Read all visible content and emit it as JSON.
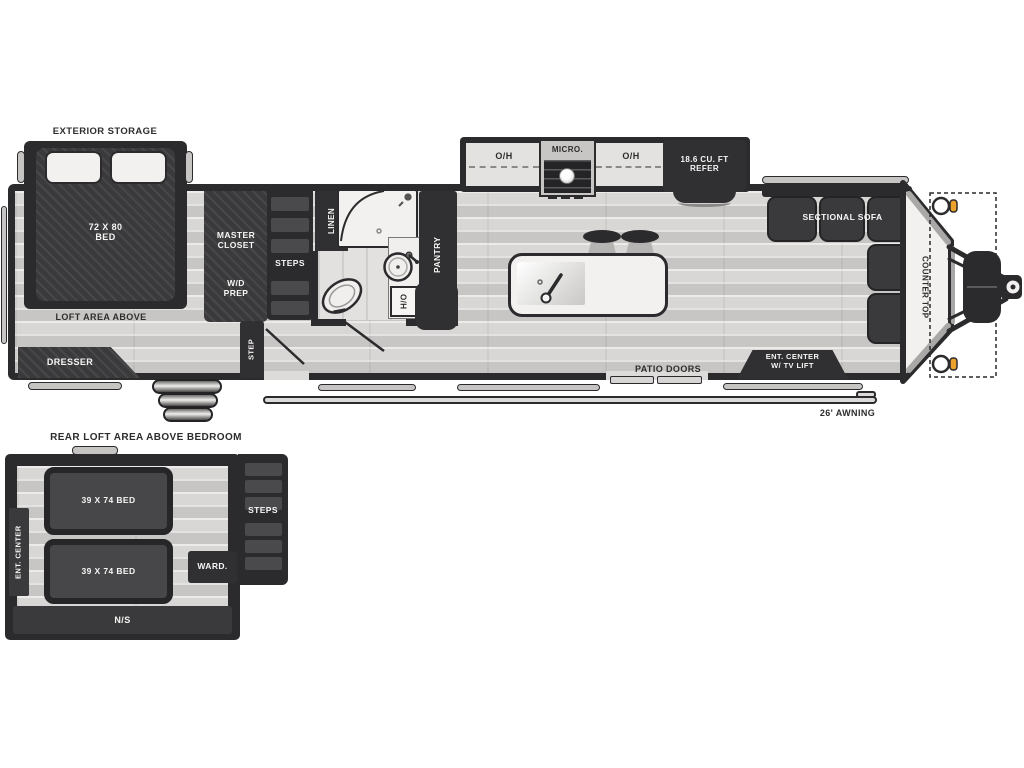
{
  "main_plan": {
    "exterior_storage_label": "EXTERIOR STORAGE",
    "bed": {
      "line1": "72 X 80",
      "line2": "BED"
    },
    "loft_label": "LOFT AREA ABOVE",
    "dresser_label": "DRESSER",
    "master_closet_label": "MASTER CLOSET",
    "wd_prep": {
      "line1": "W/D",
      "line2": "PREP"
    },
    "steps_label": "STEPS",
    "step_label": "STEP",
    "linen_label": "LINEN",
    "pantry_label": "PANTRY",
    "water_heater_label": "H/O",
    "overhead_left_label": "O/H",
    "micro_label": "MICRO.",
    "overhead_right_label": "O/H",
    "refer": {
      "line1": "18.6 CU. FT",
      "line2": "REFER"
    },
    "patio_doors_label": "PATIO DOORS",
    "ent_center": {
      "line1": "ENT. CENTER",
      "line2": "W/ TV LIFT"
    },
    "sectional_sofa_label": "SECTIONAL SOFA",
    "counter_top_label": "COUNTER TOP",
    "awning_label": "26' AWNING"
  },
  "loft_plan": {
    "title": "REAR LOFT AREA ABOVE BEDROOM",
    "bed1_label": "39 X 74 BED",
    "bed2_label": "39 X 74 BED",
    "ent_center_label": "ENT. CENTER",
    "wardrobe_label": "WARD.",
    "steps_label": "STEPS",
    "ns_label": "N/S"
  },
  "colors": {
    "wall_dark": "#2b2a2c",
    "furniture_dark": "#302f31",
    "floor_gray": "#d8d7d5",
    "fixture_white": "#f2f1ef",
    "marker_orange": "#eda12d"
  }
}
